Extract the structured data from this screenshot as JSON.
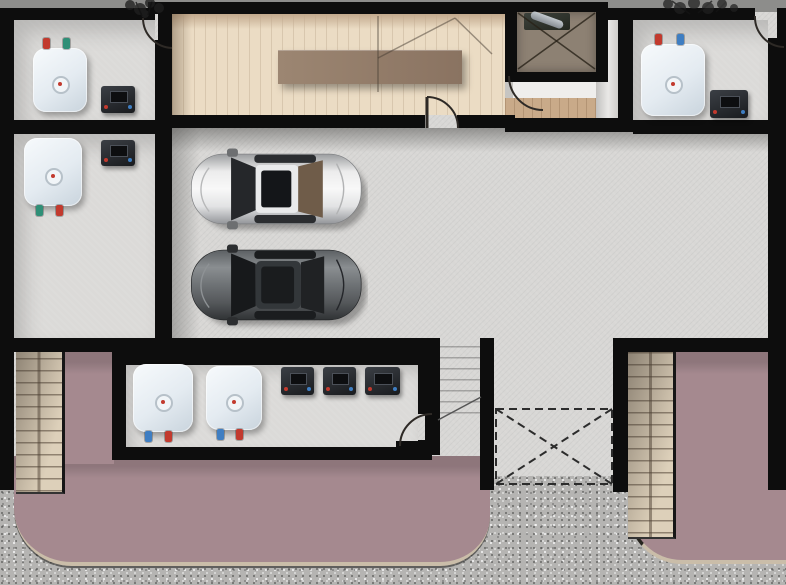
{
  "meta": {
    "scene": "Top-down architectural floor plan of a basement parking / utility level with two parked cars, five water heaters, six electrical storage boxes, an elevator shaft, three staircases, a dashed car-lift void and a mauve driveway apron",
    "width_px": 786,
    "height_px": 585
  },
  "colors": {
    "wall": "#0d0d0d",
    "concrete": "#d8d7d5",
    "concreteShadow": "#a8a7a5",
    "outside": "#8d8d8b",
    "gravel": "#b5b4b2",
    "mauve": "#a5898f",
    "mauveEdge": "#cabda9",
    "wood": "#ebdcc4",
    "woodShade": "#c2a98d",
    "table": "#97816c",
    "hallWood": "#c9aa89",
    "hallWhite": "#efeeec",
    "elevatorFloor": "#8d8173",
    "stairTan": "#ddd0ba",
    "valveRed": "#c23a2e",
    "valveBlue": "#3f7ec2",
    "valveTeal": "#2f8f77",
    "carSilver": "#e6e7e8",
    "carDark": "#4b4e51"
  },
  "inventory": {
    "water_heaters": 5,
    "electrical_boxes": 6,
    "cars": 2,
    "staircases": 3,
    "elevator_shafts": 1,
    "door_swings": 5,
    "plants": 2,
    "lift_voids": 1
  }
}
